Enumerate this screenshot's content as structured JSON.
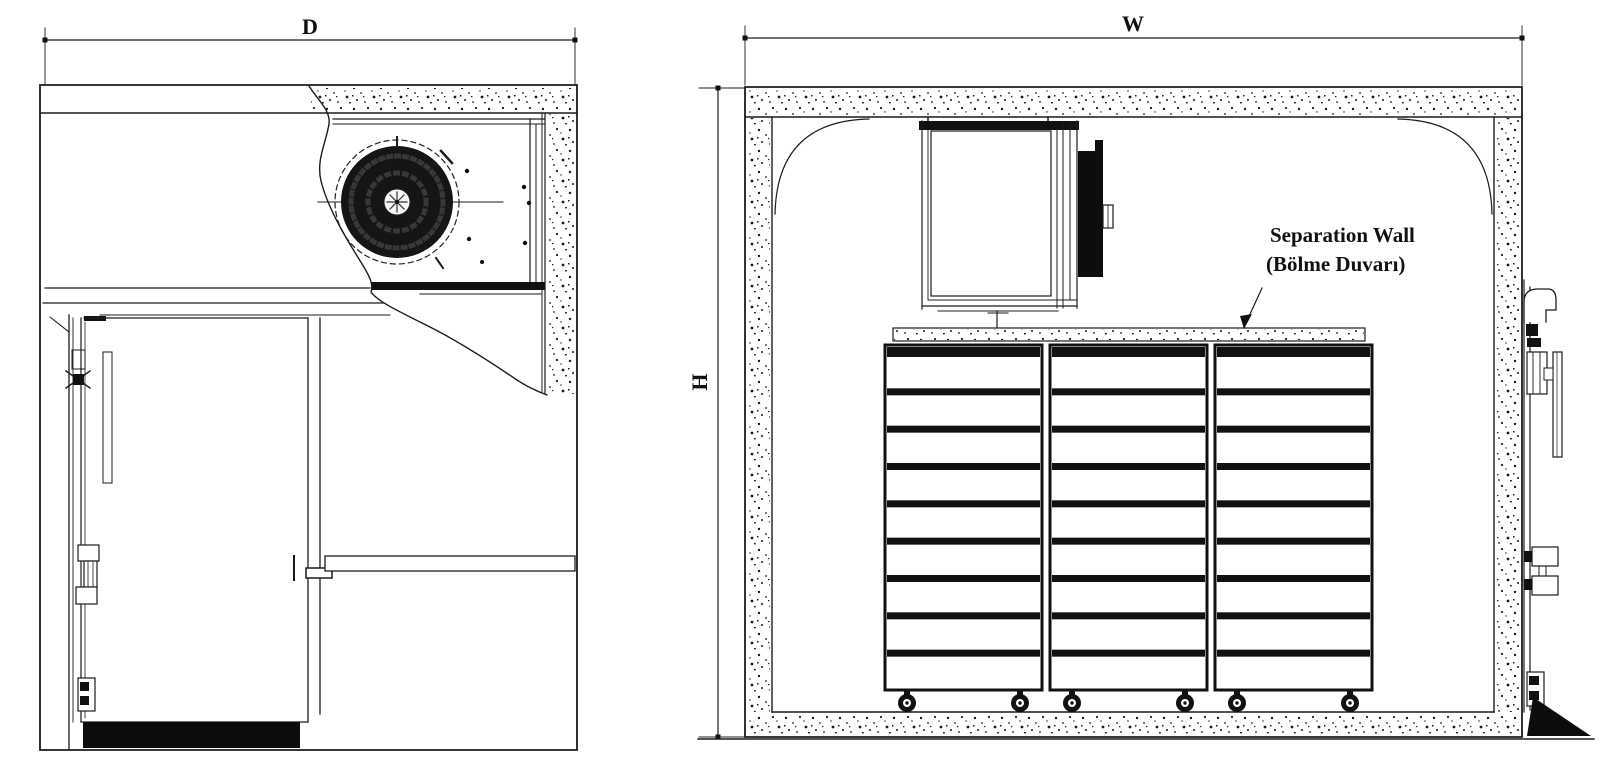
{
  "drawing": {
    "labels": {
      "depth": "D",
      "width": "W",
      "height": "H"
    },
    "annotation": {
      "line1": "Separation Wall",
      "line2": "(Bölme Duvarı)"
    },
    "racks": {
      "count": 3,
      "shelf_rows_per_rack": 9,
      "wheels_per_rack": 2
    },
    "colors": {
      "line": "#1c1c1c",
      "background": "#ffffff",
      "fill_black": "#0c0c0c",
      "speckle": "#1b1b1b"
    }
  }
}
